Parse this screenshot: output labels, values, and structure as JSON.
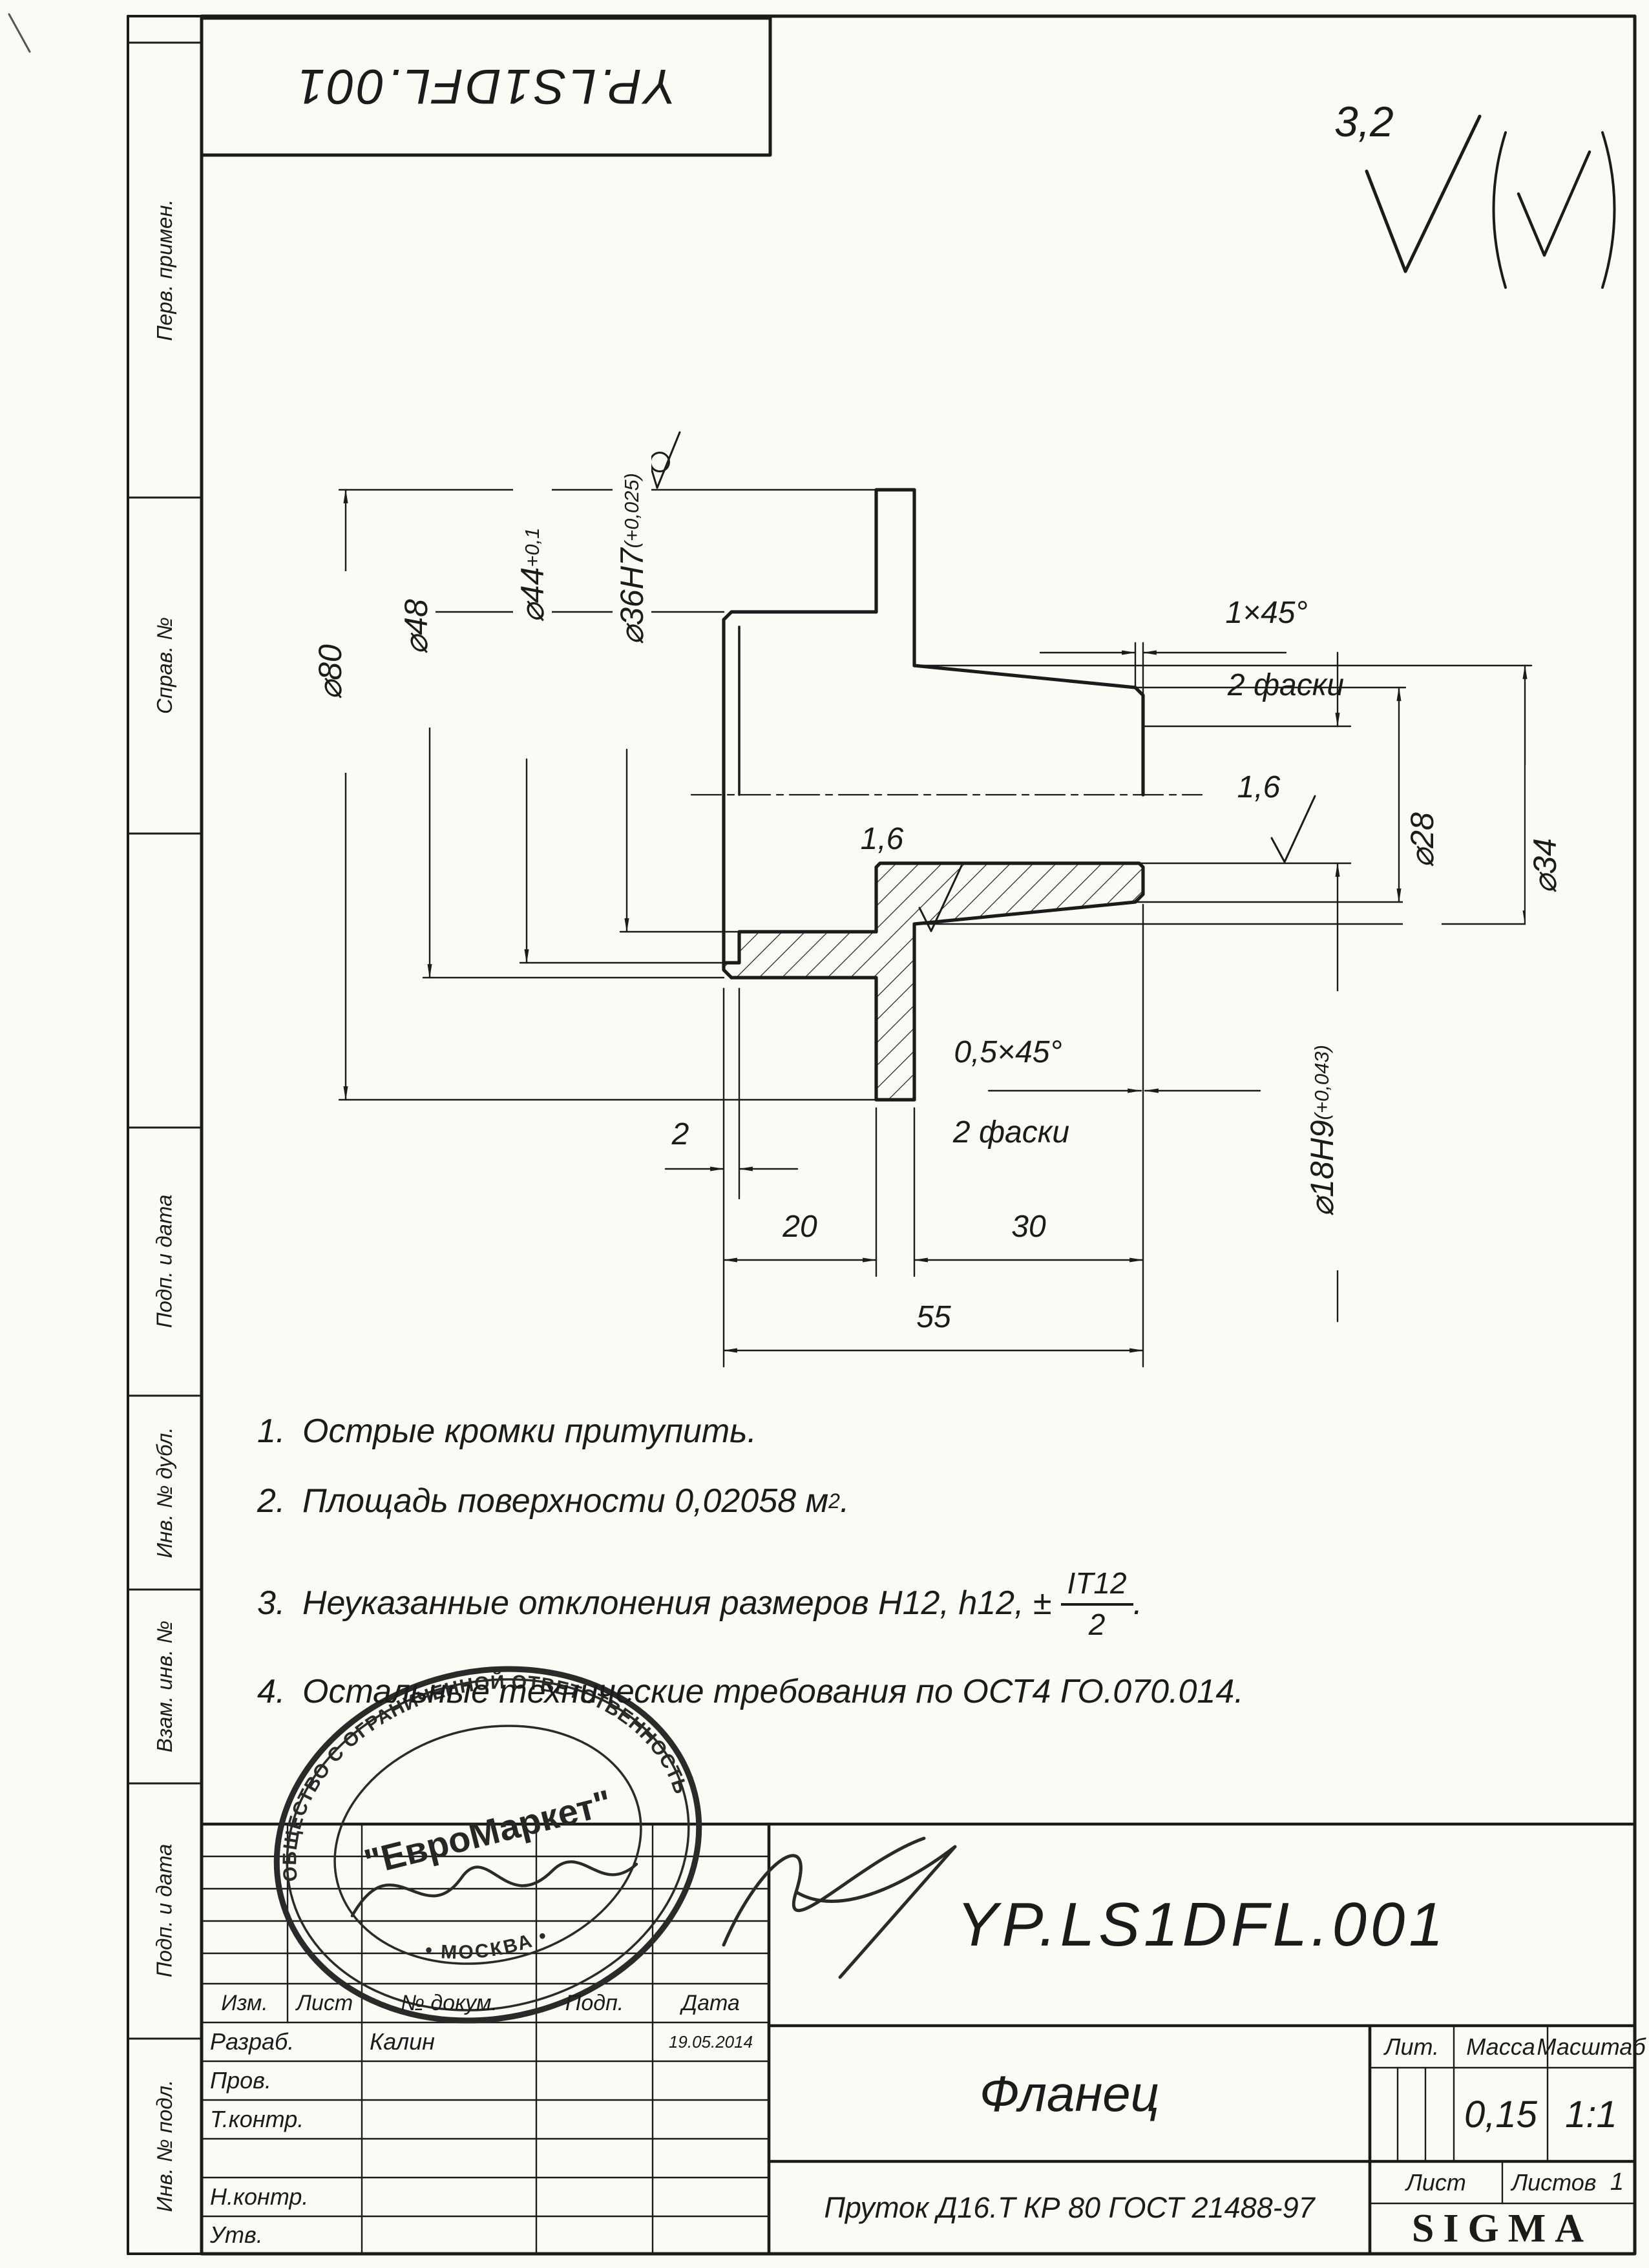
{
  "frame": {
    "designation_box": "YP.LS1DFL.001"
  },
  "margin_labels": [
    "Перв. примен.",
    "Справ. №",
    "Подп. и дата",
    "Инв. № дубл.",
    "Взам. инв. №",
    "Подп. и дата",
    "Инв. № подл."
  ],
  "general_roughness": {
    "value": "3,2"
  },
  "drawing": {
    "dims": {
      "d80": "⌀80",
      "d48": "⌀48",
      "d44": "⌀44",
      "d44_tol": "+0,1",
      "d36": "⌀36H7",
      "d36_tol": "(+0,025)",
      "d34": "⌀34",
      "d28": "⌀28",
      "d18": "⌀18H9",
      "d18_tol": "(+0,043)",
      "len2": "2",
      "len20": "20",
      "len30": "30",
      "len55": "55",
      "chamfer_outer": "1×45°",
      "chamfer_outer_note": "2 фаски",
      "chamfer_hole": "0,5×45°",
      "chamfer_hole_note": "2 фаски",
      "ra_bore": "1,6",
      "ra_hole": "1,6"
    }
  },
  "tech_requirements": {
    "item1_num": "1.",
    "item1": "Острые кромки притупить.",
    "item2_num": "2.",
    "item2": "Площадь поверхности 0,02058 м",
    "item2_sup": "2",
    "item2_end": ".",
    "item3_num": "3.",
    "item3": "Неуказанные отклонения размеров H12, h12, ±",
    "item3_frac_num": "IT12",
    "item3_frac_den": "2",
    "item3_end": ".",
    "item4_num": "4.",
    "item4": "Остальные технические требования по ОСТ4 ГО.070.014."
  },
  "title_block": {
    "designation": "YP.LS1DFL.001",
    "part_name": "Фланец",
    "material": "Пруток Д16.Т КР 80 ГОСТ 21488-97",
    "company": "SIGMA",
    "cols": {
      "izm": "Изм.",
      "list": "Лист",
      "doc": "№ докум.",
      "podp": "Подп.",
      "date": "Дата"
    },
    "rows": {
      "razrab": "Разраб.",
      "prov": "Пров.",
      "tkontr": "Т.контр.",
      "nkontr": "Н.контр.",
      "utv": "Утв."
    },
    "razrab_name": "Калин",
    "razrab_date": "19.05.2014",
    "lit_label": "Лит.",
    "mass_label": "Масса",
    "scale_label": "Масштаб",
    "mass_value": "0,15",
    "scale_value": "1:1",
    "sheet_label": "Лист",
    "sheets_label": "Листов",
    "sheets_value": "1"
  },
  "stamp": {
    "center": "\"ЕвроМаркет\"",
    "ring_top": "ОБЩЕСТВО С ОГРАНИЧЕННОЙ ОТВЕТСТВЕННОСТЬЮ",
    "ring_bottom": "• МОСКВА •"
  }
}
